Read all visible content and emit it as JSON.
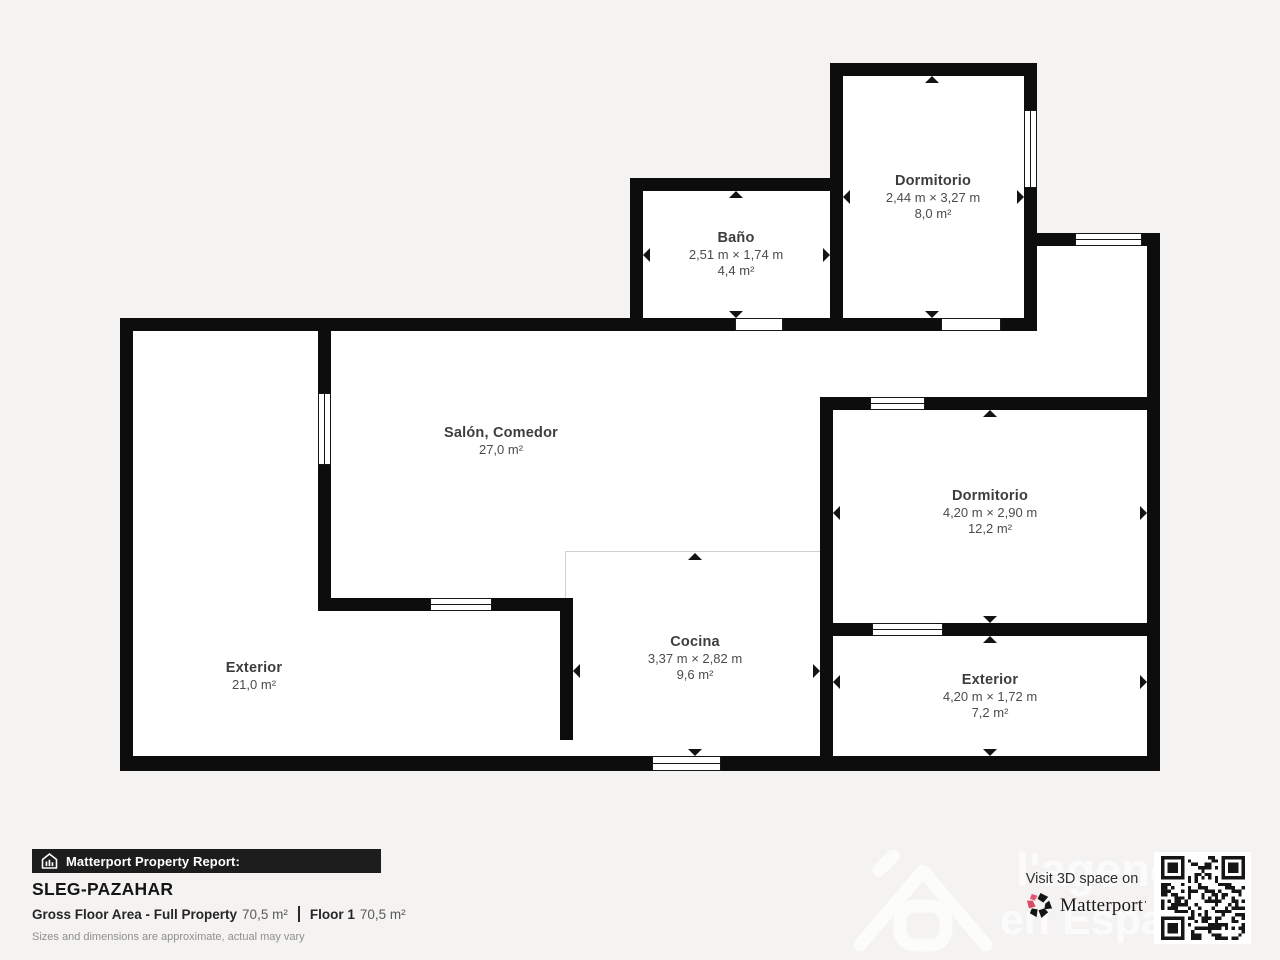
{
  "page": {
    "background": "#f4f3f1",
    "wall_color": "#0d0d0d"
  },
  "plan": {
    "rooms": [
      {
        "name": "Baño",
        "dims": "2,51 m × 1,74 m",
        "area": "4,4 m²"
      },
      {
        "name": "Dormitorio",
        "dims": "2,44 m × 3,27 m",
        "area": "8,0 m²"
      },
      {
        "name": "Salón, Comedor",
        "dims": "",
        "area": "27,0 m²"
      },
      {
        "name": "Cocina",
        "dims": "3,37 m × 2,82 m",
        "area": "9,6 m²"
      },
      {
        "name": "Dormitorio",
        "dims": "4,20 m × 2,90 m",
        "area": "12,2 m²"
      },
      {
        "name": "Exterior",
        "dims": "4,20 m × 1,72 m",
        "area": "7,2 m²"
      },
      {
        "name": "Exterior",
        "dims": "",
        "area": "21,0 m²"
      }
    ]
  },
  "footer": {
    "report_label": "Matterport Property Report:",
    "property_name": "SLEG-PAZAHAR",
    "gfa_label": "Gross Floor Area - Full Property",
    "gfa_value": "70,5 m²",
    "floor_label": "Floor 1",
    "floor_value": "70,5 m²",
    "disclaimer": "Sizes and dimensions are approximate, actual may vary"
  },
  "branding": {
    "visit_label": "Visit 3D space on",
    "brand_name": "Matterport",
    "brand_tm": "’",
    "accent_pink": "#db4a65"
  },
  "watermark": {
    "line1": "l'agence",
    "line2": "en Espagne"
  }
}
